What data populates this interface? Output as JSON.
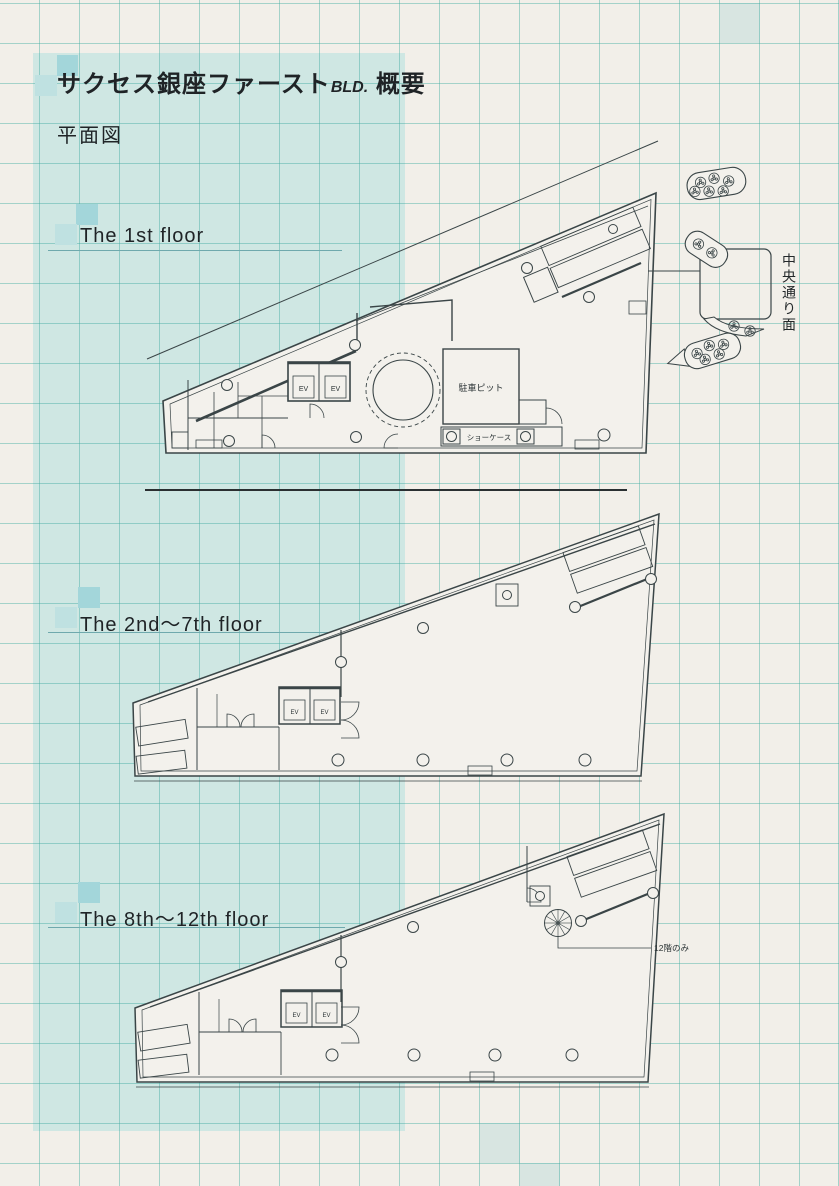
{
  "document": {
    "title_main": "サクセス銀座ファースト",
    "title_abbr": "BLD.",
    "title_suffix": "概要",
    "subtitle": "平面図"
  },
  "sections": [
    {
      "id": "floor-1",
      "label": "The 1st floor"
    },
    {
      "id": "floor-2-7",
      "label": "The 2nd〜7th floor"
    },
    {
      "id": "floor-8-12",
      "label": "The 8th〜12th floor"
    }
  ],
  "plan_annotations": {
    "elevator": "EV",
    "parking_pit": "駐車ピット",
    "showcase": "ショーケース",
    "spiral_stair_note": "12階のみ",
    "street_label": "中央通り面"
  },
  "colors": {
    "paper": "#f2efe9",
    "panel_teal": "#cfe7e3",
    "accent_square_dark": "#a3d6da",
    "accent_square_light": "#bfe1e1",
    "grid_line": "#3aa89e",
    "drawing_line": "#3a4547"
  }
}
